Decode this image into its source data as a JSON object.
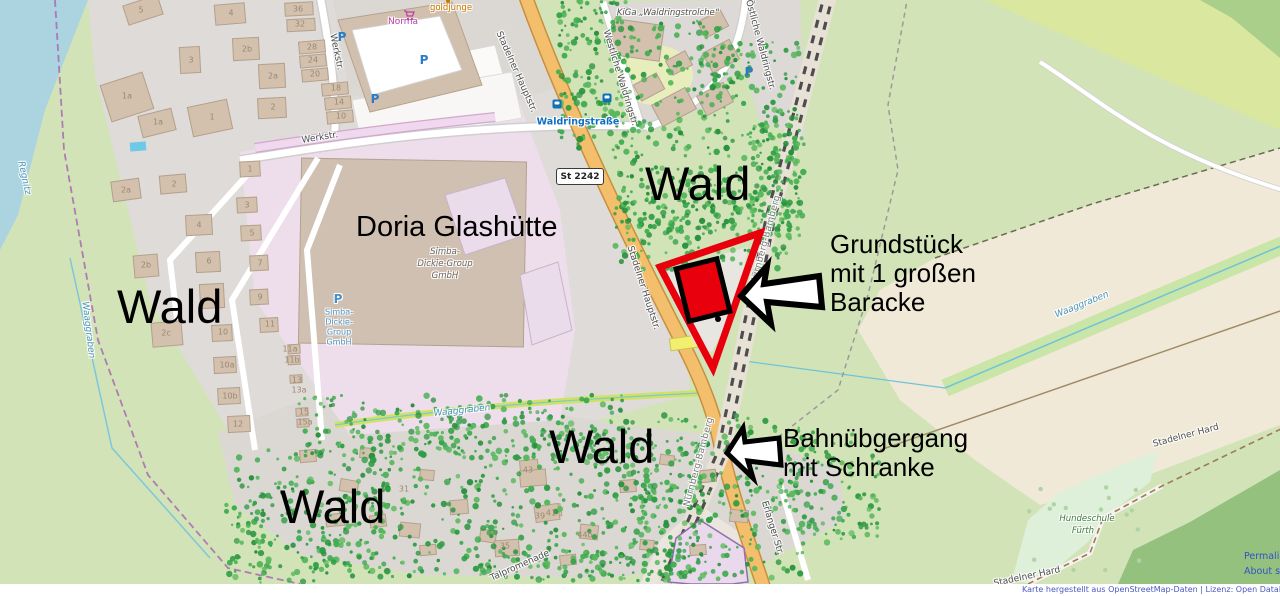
{
  "annotations": {
    "wald": [
      {
        "text": "Wald",
        "x": 645,
        "y": 160
      },
      {
        "text": "Wald",
        "x": 117,
        "y": 283
      },
      {
        "text": "Wald",
        "x": 549,
        "y": 423
      },
      {
        "text": "Wald",
        "x": 280,
        "y": 483
      }
    ],
    "doria_title": {
      "text": "Doria Glashütte"
    },
    "grundstueck": {
      "lines": [
        "Grundstück",
        "mit 1 großen",
        "Baracke"
      ]
    },
    "bahnuebergang": {
      "lines": [
        "Bahnübgergang",
        "mit Schranke"
      ]
    }
  },
  "map": {
    "shield": {
      "text": "St 2242"
    },
    "labels": [
      {
        "type": "street",
        "text": "Werkstr.",
        "x": 336,
        "y": 52,
        "r": 78
      },
      {
        "type": "street",
        "text": "Werkstr.",
        "x": 320,
        "y": 138,
        "r": -9
      },
      {
        "type": "street",
        "text": "Stadelner Hauptstr.",
        "x": 516,
        "y": 72,
        "r": 66
      },
      {
        "type": "street",
        "text": "Stadelner Hauptstr.",
        "x": 643,
        "y": 288,
        "r": 72
      },
      {
        "type": "street",
        "text": "Erlanger Str.",
        "x": 772,
        "y": 528,
        "r": 73
      },
      {
        "type": "street",
        "text": "Westliche Waldringstr.",
        "x": 620,
        "y": 78,
        "r": 73
      },
      {
        "type": "street",
        "text": "Östliche Waldringstr.",
        "x": 760,
        "y": 45,
        "r": 75
      },
      {
        "type": "street",
        "text": "Talpromenade",
        "x": 520,
        "y": 566,
        "r": -24
      },
      {
        "type": "street",
        "text": "Stadelner Hard",
        "x": 1186,
        "y": 436,
        "r": -15
      },
      {
        "type": "street",
        "text": "Stadelner Hard",
        "x": 1027,
        "y": 577,
        "r": -12
      },
      {
        "type": "rail",
        "text": "Nürnberg-Bamberg",
        "x": 766,
        "y": 240,
        "r": -75
      },
      {
        "type": "rail",
        "text": "Nürnberg-Bamberg",
        "x": 699,
        "y": 462,
        "r": -75
      },
      {
        "type": "water",
        "text": "Regnitz",
        "x": 24,
        "y": 178,
        "r": 78
      },
      {
        "type": "water",
        "text": "Waaggraben",
        "x": 88,
        "y": 330,
        "r": 83
      },
      {
        "type": "water",
        "text": "Waaggraben",
        "x": 462,
        "y": 411,
        "r": -6
      },
      {
        "type": "water",
        "text": "Waaggraben",
        "x": 1082,
        "y": 305,
        "r": -22
      },
      {
        "type": "transit",
        "text": "Waldringstraße",
        "x": 578,
        "y": 122,
        "r": 0
      },
      {
        "type": "shop",
        "text": "Norma",
        "x": 403,
        "y": 22,
        "r": 0
      },
      {
        "type": "amen",
        "text": "goldjunge",
        "x": 451,
        "y": 8,
        "r": 0
      },
      {
        "type": "kiga",
        "text": "KiGa „Waldringstrolche“",
        "x": 668,
        "y": 13,
        "r": 0
      },
      {
        "type": "grn",
        "text": "Hundeschule",
        "x": 1087,
        "y": 519,
        "r": 0
      },
      {
        "type": "grn",
        "text": "Fürth",
        "x": 1083,
        "y": 531,
        "r": 0
      },
      {
        "type": "ind",
        "text": "Simba-",
        "x": 445,
        "y": 252,
        "r": 0
      },
      {
        "type": "ind",
        "text": "Dickie-Group",
        "x": 445,
        "y": 264,
        "r": 0
      },
      {
        "type": "ind",
        "text": "GmbH",
        "x": 445,
        "y": 276,
        "r": 0
      },
      {
        "type": "pbluebig",
        "text": "P",
        "x": 338,
        "y": 299,
        "r": 0
      },
      {
        "type": "pblue",
        "text": "Simba-",
        "x": 339,
        "y": 312,
        "r": 0
      },
      {
        "type": "pblue",
        "text": "Dickie-",
        "x": 339,
        "y": 322,
        "r": 0
      },
      {
        "type": "pblue",
        "text": "Group",
        "x": 339,
        "y": 332,
        "r": 0
      },
      {
        "type": "pblue",
        "text": "GmbH",
        "x": 339,
        "y": 342,
        "r": 0
      }
    ],
    "icons": [
      {
        "type": "parking",
        "x": 342,
        "y": 37
      },
      {
        "type": "parking",
        "x": 424,
        "y": 60
      },
      {
        "type": "parking",
        "x": 375,
        "y": 99
      },
      {
        "type": "parking",
        "x": 749,
        "y": 72
      },
      {
        "type": "bus",
        "x": 557,
        "y": 104
      },
      {
        "type": "bus",
        "x": 607,
        "y": 98
      },
      {
        "type": "cart",
        "x": 403,
        "y": 10
      },
      {
        "type": "poidot",
        "x": 448,
        "y": 1
      }
    ],
    "housenumbers": [
      [
        141,
        10,
        "5"
      ],
      [
        231,
        13,
        "4"
      ],
      [
        298,
        9,
        "36"
      ],
      [
        300,
        24,
        "32"
      ],
      [
        247,
        49,
        "2b"
      ],
      [
        191,
        60,
        "3"
      ],
      [
        312,
        47,
        "28"
      ],
      [
        313,
        60,
        "24"
      ],
      [
        273,
        76,
        "2a"
      ],
      [
        315,
        74,
        "20"
      ],
      [
        127,
        96,
        "1a"
      ],
      [
        336,
        88,
        "18"
      ],
      [
        273,
        107,
        "2"
      ],
      [
        339,
        102,
        "14"
      ],
      [
        212,
        117,
        "1"
      ],
      [
        341,
        116,
        "10"
      ],
      [
        158,
        122,
        "1a"
      ],
      [
        126,
        190,
        "2a"
      ],
      [
        174,
        184,
        "2"
      ],
      [
        250,
        169,
        "1"
      ],
      [
        199,
        225,
        "4"
      ],
      [
        247,
        205,
        "3"
      ],
      [
        252,
        233,
        "5"
      ],
      [
        146,
        265,
        "2b"
      ],
      [
        209,
        261,
        "6"
      ],
      [
        260,
        263,
        "7"
      ],
      [
        260,
        297,
        "9"
      ],
      [
        166,
        333,
        "2c"
      ],
      [
        223,
        332,
        "10"
      ],
      [
        270,
        324,
        "11"
      ],
      [
        290,
        349,
        "11a"
      ],
      [
        292,
        360,
        "11b"
      ],
      [
        227,
        365,
        "10a"
      ],
      [
        297,
        380,
        "13"
      ],
      [
        299,
        390,
        "13a"
      ],
      [
        230,
        396,
        "10b"
      ],
      [
        304,
        412,
        "15"
      ],
      [
        305,
        422,
        "15a"
      ],
      [
        238,
        424,
        "12"
      ],
      [
        528,
        470,
        "43"
      ],
      [
        540,
        516,
        "39"
      ],
      [
        551,
        513,
        "41"
      ],
      [
        505,
        546,
        "35"
      ],
      [
        404,
        489,
        "31"
      ],
      [
        585,
        535,
        "44b"
      ]
    ],
    "buildings": [
      [
        143,
        10,
        36,
        20,
        -18
      ],
      [
        230,
        14,
        30,
        20,
        -5
      ],
      [
        299,
        9,
        28,
        13,
        -3
      ],
      [
        301,
        25,
        28,
        12,
        -3
      ],
      [
        246,
        49,
        26,
        22,
        -3
      ],
      [
        190,
        60,
        20,
        26,
        -3
      ],
      [
        312,
        47,
        26,
        12,
        -5
      ],
      [
        313,
        61,
        26,
        12,
        -5
      ],
      [
        272,
        76,
        26,
        24,
        -3
      ],
      [
        315,
        75,
        26,
        12,
        -5
      ],
      [
        127,
        97,
        44,
        38,
        -18
      ],
      [
        335,
        89,
        26,
        12,
        -5
      ],
      [
        272,
        108,
        28,
        20,
        -3
      ],
      [
        338,
        103,
        26,
        12,
        -5
      ],
      [
        210,
        118,
        40,
        30,
        -12
      ],
      [
        340,
        117,
        26,
        12,
        -5
      ],
      [
        157,
        123,
        34,
        22,
        -14
      ],
      [
        126,
        190,
        28,
        20,
        -8
      ],
      [
        173,
        184,
        26,
        18,
        -5
      ],
      [
        250,
        169,
        20,
        15,
        -3
      ],
      [
        199,
        225,
        26,
        20,
        -3
      ],
      [
        247,
        205,
        20,
        15,
        -3
      ],
      [
        251,
        233,
        20,
        15,
        -3
      ],
      [
        146,
        266,
        24,
        22,
        -5
      ],
      [
        208,
        262,
        24,
        20,
        -3
      ],
      [
        259,
        263,
        18,
        15,
        -3
      ],
      [
        259,
        297,
        18,
        15,
        -3
      ],
      [
        212,
        296,
        24,
        24,
        -3
      ],
      [
        167,
        334,
        30,
        24,
        -5
      ],
      [
        222,
        333,
        20,
        16,
        -3
      ],
      [
        269,
        325,
        18,
        14,
        -3
      ],
      [
        225,
        365,
        22,
        16,
        -3
      ],
      [
        229,
        396,
        22,
        16,
        -3
      ],
      [
        239,
        424,
        22,
        16,
        -3
      ],
      [
        294,
        349,
        12,
        9,
        -3
      ],
      [
        294,
        360,
        12,
        9,
        -3
      ],
      [
        296,
        379,
        12,
        8,
        -3
      ],
      [
        302,
        412,
        12,
        8,
        -3
      ],
      [
        303,
        423,
        12,
        8,
        -3
      ],
      [
        637,
        40,
        50,
        36,
        8
      ],
      [
        713,
        24,
        26,
        18,
        -28
      ],
      [
        721,
        56,
        30,
        22,
        -28
      ],
      [
        679,
        63,
        22,
        16,
        -28
      ],
      [
        649,
        87,
        26,
        18,
        -28
      ],
      [
        674,
        107,
        38,
        24,
        -28
      ],
      [
        715,
        99,
        30,
        22,
        -28
      ],
      [
        308,
        456,
        16,
        12,
        -5
      ],
      [
        349,
        486,
        18,
        12,
        10
      ],
      [
        378,
        521,
        16,
        12,
        -8
      ],
      [
        427,
        475,
        14,
        10,
        5
      ],
      [
        459,
        507,
        18,
        14,
        -5
      ],
      [
        488,
        536,
        16,
        12,
        8
      ],
      [
        529,
        466,
        18,
        12,
        -5
      ],
      [
        553,
        511,
        16,
        12,
        -10
      ],
      [
        589,
        532,
        18,
        14,
        6
      ],
      [
        628,
        486,
        16,
        12,
        -4
      ],
      [
        667,
        460,
        14,
        10,
        8
      ],
      [
        708,
        476,
        16,
        12,
        -6
      ],
      [
        739,
        516,
        18,
        12,
        5
      ],
      [
        428,
        550,
        16,
        10,
        -5
      ],
      [
        367,
        453,
        14,
        10,
        4
      ],
      [
        568,
        560,
        16,
        10,
        -6
      ],
      [
        647,
        545,
        14,
        10,
        5
      ],
      [
        698,
        550,
        16,
        10,
        -4
      ],
      [
        533,
        478,
        26,
        16,
        -5
      ],
      [
        547,
        513,
        24,
        16,
        -8
      ],
      [
        507,
        548,
        24,
        16,
        -4
      ],
      [
        410,
        530,
        20,
        14,
        6
      ],
      [
        335,
        520,
        18,
        12,
        -6
      ]
    ],
    "decor": {
      "tree_clusters": [
        [
          558,
          0,
          70,
          150,
          140
        ],
        [
          612,
          20,
          125,
          210,
          220
        ],
        [
          700,
          42,
          100,
          195,
          190
        ],
        [
          750,
          120,
          55,
          110,
          90
        ],
        [
          615,
          190,
          175,
          80,
          160
        ],
        [
          225,
          450,
          165,
          125,
          180
        ],
        [
          295,
          395,
          330,
          65,
          240
        ],
        [
          365,
          435,
          340,
          145,
          360
        ],
        [
          600,
          415,
          205,
          165,
          280
        ],
        [
          765,
          428,
          115,
          115,
          140
        ],
        [
          470,
          550,
          260,
          32,
          80
        ],
        [
          235,
          498,
          130,
          85,
          70
        ]
      ],
      "paw_area": [
        1025,
        478,
        125,
        95,
        16
      ]
    }
  },
  "footer": {
    "attribution": "Karte hergestellt aus OpenStreetMap-Daten | Lizenz: Open Database License (ODbL)",
    "links": [
      "Permalink",
      "About style"
    ]
  },
  "colors": {
    "annotation_red": "#e8000d",
    "arrow_fill": "#ffffff",
    "road_orange": "#f3bf6d",
    "water": "#abd4e0",
    "tree_green": "#2f9e44"
  }
}
